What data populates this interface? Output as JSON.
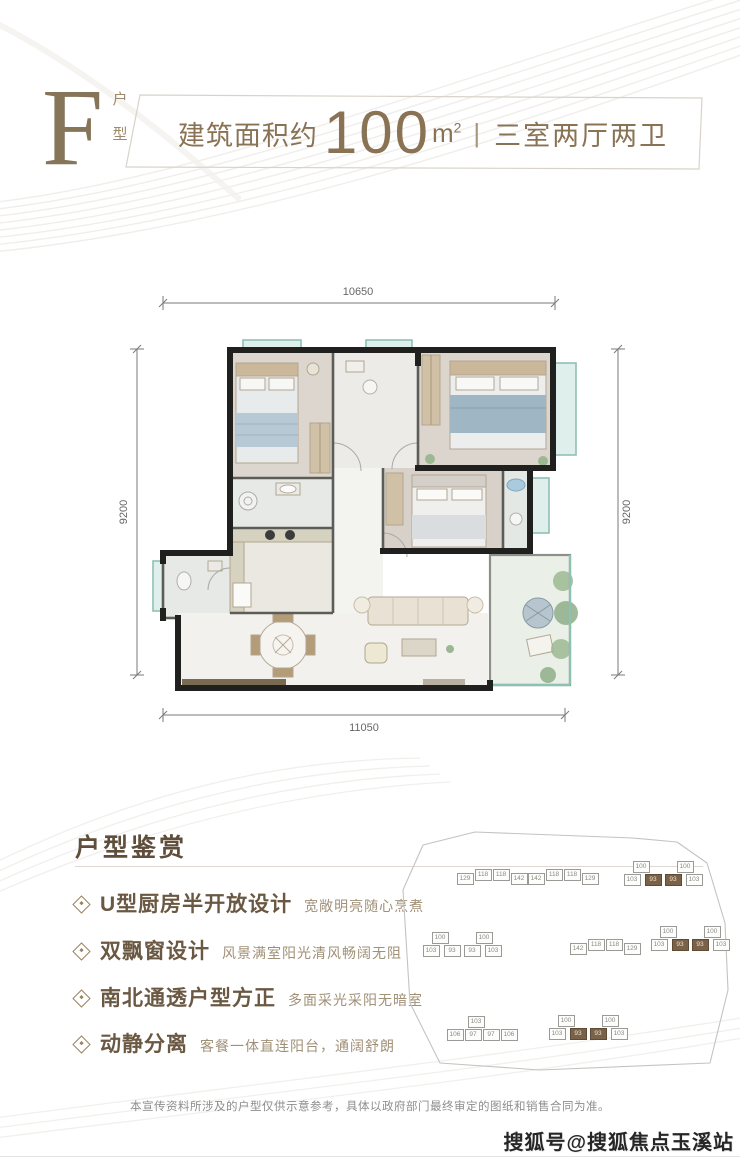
{
  "header": {
    "type_letter": "F",
    "type_label_char1": "户",
    "type_label_char2": "型",
    "area_prefix": "建筑面积约",
    "area_value": "100",
    "area_unit": "m",
    "area_sup": "2",
    "divider": "|",
    "layout_text": "三室两厅两卫",
    "accent_color": "#8a7355"
  },
  "floorplan": {
    "dim_top": "10650",
    "dim_bottom": "11050",
    "dim_left": "9200",
    "dim_right": "9200"
  },
  "features": {
    "section_title": "户型鉴赏",
    "items": [
      {
        "title": "U型厨房半开放设计",
        "desc": "宽敞明亮随心烹煮"
      },
      {
        "title": "双飘窗设计",
        "desc": "风景满室阳光清风畅阔无阻"
      },
      {
        "title": "南北通透户型方正",
        "desc": "多面采光采阳无暗室"
      },
      {
        "title": "动静分离",
        "desc": "客餐一体直连阳台，通阔舒朗"
      }
    ]
  },
  "siteplan": {
    "highlight_color": "#7a6248",
    "buildings": [
      {
        "cx": 492,
        "cy": 878,
        "cells": [
          {
            "t": "129",
            "dx": -27,
            "dy": 1
          },
          {
            "t": "118",
            "dx": -9,
            "dy": -3
          },
          {
            "t": "118",
            "dx": 9,
            "dy": -3
          },
          {
            "t": "142",
            "dx": 27,
            "dy": 1
          }
        ]
      },
      {
        "cx": 563,
        "cy": 878,
        "cells": [
          {
            "t": "142",
            "dx": -27,
            "dy": 1
          },
          {
            "t": "118",
            "dx": -9,
            "dy": -3
          },
          {
            "t": "118",
            "dx": 9,
            "dy": -3
          },
          {
            "t": "129",
            "dx": 27,
            "dy": 1
          }
        ]
      },
      {
        "cx": 663,
        "cy": 876,
        "cells": [
          {
            "t": "100",
            "dx": -22,
            "dy": -9
          },
          {
            "t": "100",
            "dx": 22,
            "dy": -9
          },
          {
            "t": "103",
            "dx": -31,
            "dy": 4
          },
          {
            "t": "93",
            "dx": -10,
            "dy": 4,
            "dark": true
          },
          {
            "t": "93",
            "dx": 10,
            "dy": 4,
            "dark": true
          },
          {
            "t": "103",
            "dx": 31,
            "dy": 4
          }
        ]
      },
      {
        "cx": 462,
        "cy": 947,
        "cells": [
          {
            "t": "100",
            "dx": -22,
            "dy": -9
          },
          {
            "t": "100",
            "dx": 22,
            "dy": -9
          },
          {
            "t": "103",
            "dx": -31,
            "dy": 4
          },
          {
            "t": "93",
            "dx": -10,
            "dy": 4
          },
          {
            "t": "93",
            "dx": 10,
            "dy": 4
          },
          {
            "t": "103",
            "dx": 31,
            "dy": 4
          }
        ]
      },
      {
        "cx": 605,
        "cy": 948,
        "cells": [
          {
            "t": "142",
            "dx": -27,
            "dy": 1
          },
          {
            "t": "118",
            "dx": -9,
            "dy": -3
          },
          {
            "t": "118",
            "dx": 9,
            "dy": -3
          },
          {
            "t": "129",
            "dx": 27,
            "dy": 1
          }
        ]
      },
      {
        "cx": 690,
        "cy": 941,
        "cells": [
          {
            "t": "100",
            "dx": -22,
            "dy": -9
          },
          {
            "t": "100",
            "dx": 22,
            "dy": -9
          },
          {
            "t": "103",
            "dx": -31,
            "dy": 4
          },
          {
            "t": "93",
            "dx": -10,
            "dy": 4,
            "dark": true
          },
          {
            "t": "93",
            "dx": 10,
            "dy": 4,
            "dark": true
          },
          {
            "t": "103",
            "dx": 31,
            "dy": 4
          }
        ]
      },
      {
        "cx": 482,
        "cy": 1031,
        "cells": [
          {
            "t": "103",
            "dx": -6,
            "dy": -9
          },
          {
            "t": "106",
            "dx": -27,
            "dy": 4
          },
          {
            "t": "97",
            "dx": -9,
            "dy": 4
          },
          {
            "t": "97",
            "dx": 9,
            "dy": 4
          },
          {
            "t": "106",
            "dx": 27,
            "dy": 4
          }
        ]
      },
      {
        "cx": 588,
        "cy": 1030,
        "cells": [
          {
            "t": "100",
            "dx": -22,
            "dy": -9
          },
          {
            "t": "100",
            "dx": 22,
            "dy": -9
          },
          {
            "t": "103",
            "dx": -31,
            "dy": 4
          },
          {
            "t": "93",
            "dx": -10,
            "dy": 4,
            "dark": true
          },
          {
            "t": "93",
            "dx": 10,
            "dy": 4,
            "dark": true
          },
          {
            "t": "103",
            "dx": 31,
            "dy": 4
          }
        ]
      }
    ]
  },
  "footer": {
    "disclaimer": "本宣传资料所涉及的户型仅供示意参考，具体以政府部门最终审定的图纸和销售合同为准。",
    "watermark": "搜狐号@搜狐焦点玉溪站"
  }
}
